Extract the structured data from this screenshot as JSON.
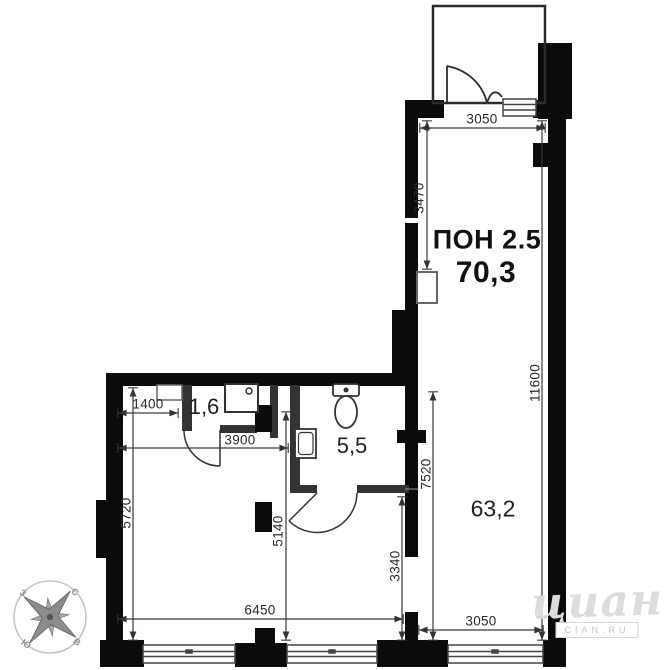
{
  "floorplan": {
    "unit": {
      "type_label": "ПОН 2.5",
      "total_area": "70,3"
    },
    "rooms": {
      "main_area": "63,2",
      "bathroom_area": "5,5",
      "shower_area": "1,6"
    },
    "dimensions": {
      "top_width": "3050",
      "upper_height": "3470",
      "right_height": "11600",
      "lower_right_height": "7520",
      "passage_height": "3340",
      "mid_height": "5140",
      "left_height": "5720",
      "niche_width": "1400",
      "inner_width": "3900",
      "bottom_width": "6450",
      "bottom_right_width": "3050"
    },
    "compass": {
      "north": "С",
      "south": "Ю",
      "west": "З",
      "east": "В"
    },
    "watermark": {
      "logo": "циан",
      "site": "CIAN.RU"
    },
    "colors": {
      "wall": "#0b0b0b",
      "partition": "#333333",
      "dimension": "#3a3a3a",
      "watermark": "#dcdcdc"
    }
  }
}
